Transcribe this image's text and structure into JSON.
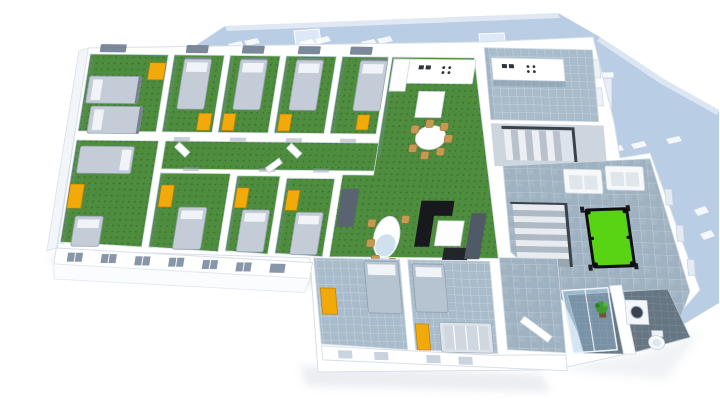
{
  "meta": {
    "title": "3D cutaway floor plan render",
    "view": "isometric dollhouse view, upper floor",
    "background_note": "white background, light blue roof planes"
  },
  "colors": {
    "background": "#ffffff",
    "roof": "#b9cde5",
    "roof_ridge": "#dce8f5",
    "wall": "#ffffff",
    "wall_edge": "#d8dfe8",
    "carpet": "#4e8c3e",
    "carpet_dot": "#3a6e2e",
    "tile_light": "#a9bccb",
    "tile_mid": "#9fb2c1",
    "tile_dark": "#677683",
    "cabinet_yellow": "#f2a90a",
    "wardrobe_dark": "#596470",
    "bed_duvet": "#c3ccd7",
    "bed_duvet_blue": "#b6c4d2",
    "bed_pillow": "#f0f3f7",
    "sofa_black": "#17191d",
    "sofa_white": "#f6f8fa",
    "pool_green": "#58d415",
    "pool_rim": "#101010",
    "table_white": "#ffffff",
    "chair_tan": "#c49a52",
    "plant_green": "#3f9b2f",
    "glass_blue": "#a8c8e0",
    "appliance_dark": "#2e343b",
    "window_dark": "#64748a"
  },
  "rooms": [
    {
      "name": "dorm-room-corner-north",
      "floor": "green-carpet",
      "furniture": [
        "double-bed",
        "double-bed",
        "yellow-cabinet",
        "window"
      ]
    },
    {
      "name": "dorm-room-north-2",
      "floor": "green-carpet",
      "furniture": [
        "single-bed",
        "yellow-cabinet",
        "window"
      ]
    },
    {
      "name": "dorm-room-north-3",
      "floor": "green-carpet",
      "furniture": [
        "single-bed",
        "yellow-cabinet",
        "window"
      ]
    },
    {
      "name": "dorm-room-north-4",
      "floor": "green-carpet",
      "furniture": [
        "single-bed",
        "yellow-cabinet",
        "window"
      ]
    },
    {
      "name": "dorm-room-north-5",
      "floor": "green-carpet",
      "furniture": [
        "single-bed",
        "yellow-cabinet",
        "window"
      ]
    },
    {
      "name": "corridor",
      "floor": "green-carpet",
      "furniture": [
        "doors"
      ]
    },
    {
      "name": "dorm-room-corner-south",
      "floor": "green-carpet",
      "furniture": [
        "double-bed",
        "single-bed",
        "yellow-cabinet"
      ]
    },
    {
      "name": "dorm-room-south-2",
      "floor": "green-carpet",
      "furniture": [
        "single-bed",
        "yellow-cabinet"
      ]
    },
    {
      "name": "dorm-room-south-3",
      "floor": "green-carpet",
      "furniture": [
        "single-bed",
        "yellow-cabinet"
      ]
    },
    {
      "name": "dorm-room-south-4",
      "floor": "green-carpet",
      "furniture": [
        "single-bed",
        "yellow-cabinet"
      ]
    },
    {
      "name": "common-room",
      "floor": "green-carpet",
      "furniture": [
        "kitchenette-counter",
        "island-table",
        "round-dining-table",
        "dining-chairs",
        "oval-table",
        "chairs",
        "black-corner-sofa",
        "coffee-table",
        "tv-stand",
        "dark-wardrobe",
        "dark-armchair"
      ]
    },
    {
      "name": "kitchen",
      "floor": "blue-tile",
      "furniture": [
        "counter-with-sink",
        "stove",
        "windows"
      ]
    },
    {
      "name": "stair-hall-north",
      "floor": "grey-tile",
      "furniture": [
        "staircase",
        "railing"
      ]
    },
    {
      "name": "recreation-room",
      "floor": "grey-tile",
      "furniture": [
        "pool-table",
        "sofa",
        "sofa",
        "staircase"
      ]
    },
    {
      "name": "south-bedroom-1",
      "floor": "blue-grey-tile",
      "furniture": [
        "double-bed",
        "yellow-cabinet"
      ]
    },
    {
      "name": "south-bedroom-2",
      "floor": "blue-grey-tile",
      "furniture": [
        "single-bed",
        "bunk-bed",
        "yellow-cabinet"
      ]
    },
    {
      "name": "hallway-south",
      "floor": "grey-tile",
      "furniture": [
        "door"
      ]
    },
    {
      "name": "bathroom",
      "floor": "dark-tile",
      "furniture": [
        "glass-shower",
        "plant",
        "washing-machine",
        "toilet"
      ]
    }
  ],
  "exterior": {
    "roof": "light blue hip roof with white skylight vents and chimney",
    "facade": "white facade strip with pairs of small windows",
    "shadow": "soft grey ground shadow"
  }
}
